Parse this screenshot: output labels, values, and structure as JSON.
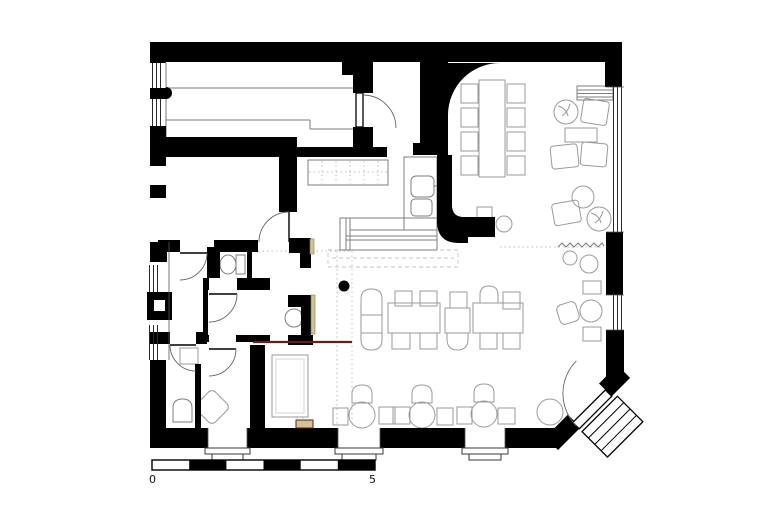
{
  "drawing": {
    "type": "architectural-floor-plan",
    "view": "top-down",
    "subject": "restaurant / pub ground floor with bar, dining areas, lounge and WC block"
  },
  "scale_bar": {
    "start_label": "0",
    "end_label": "5",
    "segment_count": 6
  },
  "colors": {
    "background": "#ffffff",
    "walls": "#000000",
    "furniture_outline": "#9a9a9a",
    "fixture_outline": "#7d7d7d",
    "dotted_guides": "#bcbcbc",
    "wood_door_leaf": "#cfc492",
    "lintel_beam": "#5f1f1f"
  },
  "legend": {
    "rooms": [
      "long-lane-room",
      "side-room",
      "bar-area",
      "rear-lounge-room",
      "main-dining-room",
      "wc-lobby",
      "wc-cubicle",
      "washroom",
      "urinal-room",
      "shower-room",
      "private-room",
      "corner-entrance"
    ],
    "fixtures": [
      "bar-counter",
      "back-counter",
      "sink-counter",
      "long-table-with-eight-chairs",
      "dining-tables-with-chairs",
      "round-window-tables",
      "lounge-chairs",
      "radiator",
      "plants",
      "curtain",
      "toilet",
      "washbasin",
      "urinal",
      "structural-column",
      "entrance-steps"
    ]
  }
}
